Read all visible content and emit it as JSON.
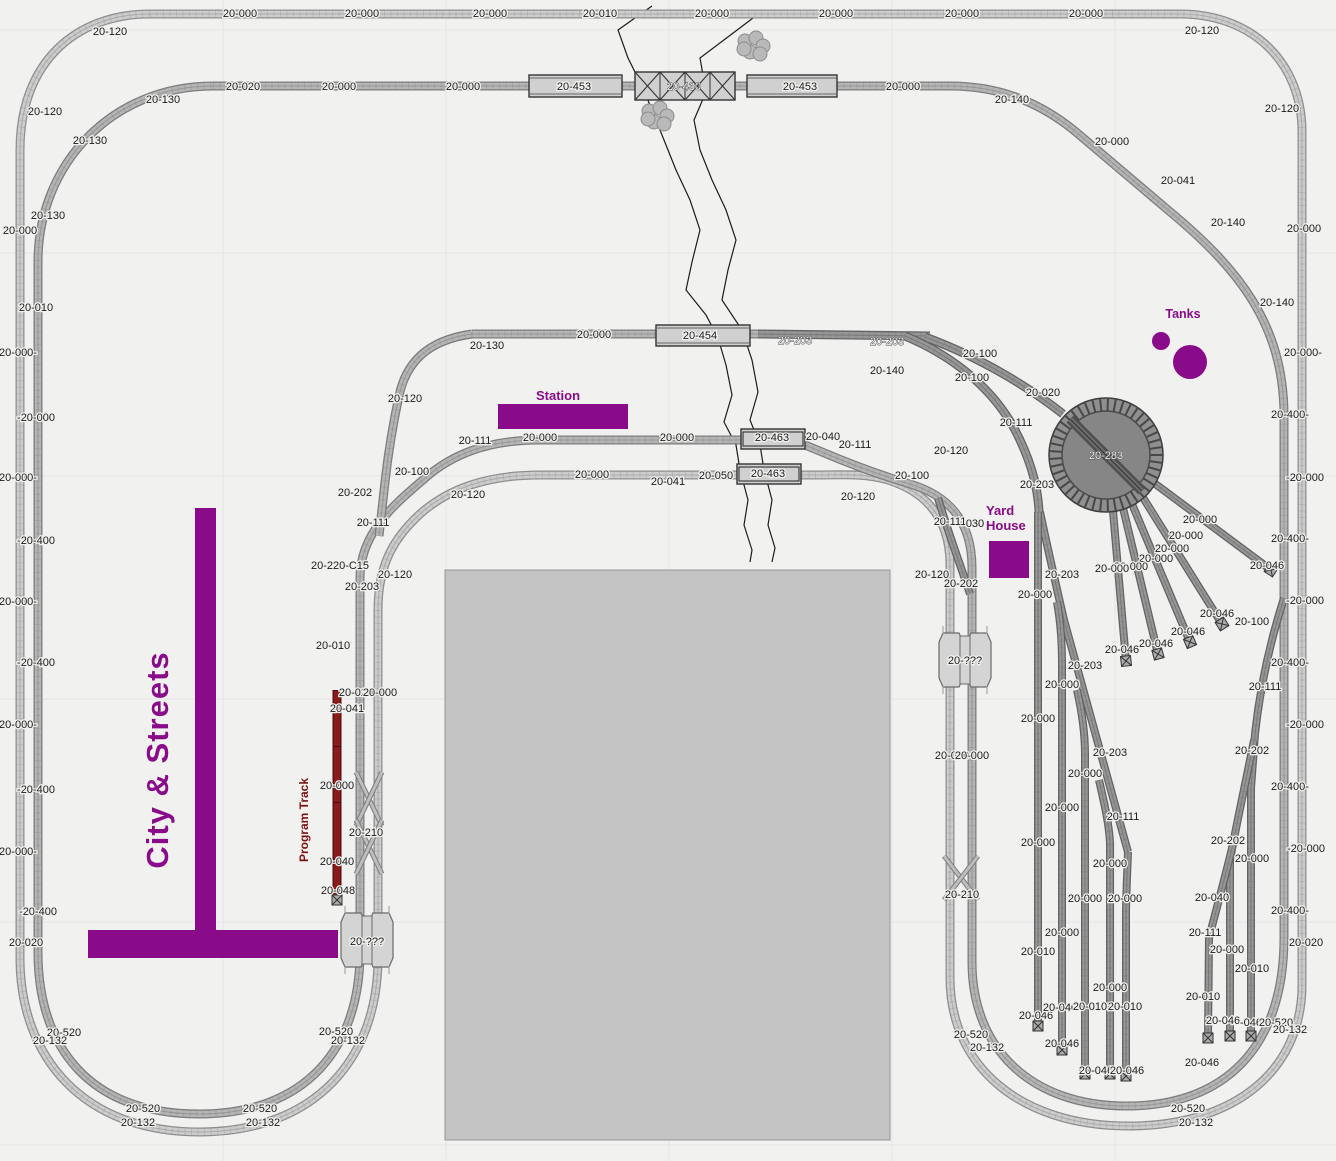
{
  "canvas": {
    "width": 1336,
    "height": 1161,
    "bg": "#f1f1ef"
  },
  "colors": {
    "accent": "#8a0b8a",
    "program_red": "#8b1a1a",
    "program_red_dark": "#541010",
    "program_text": "#7c1212",
    "label": "#1b1b1b",
    "halo": "#f1f1ef",
    "grid": "#e5e5e8",
    "river": "#1c1c1c",
    "building_fill": "#c3c3c3",
    "building_edge": "#979797",
    "light_fill": "#cdcdcd",
    "light_edge": "#8f8f8f",
    "med_fill": "#b5b5b5",
    "med_edge": "#7d7d7d",
    "dark_fill": "#979797",
    "dark_edge": "#636363",
    "bridge_fill": "#d0d0d0",
    "bridge_edge": "#333333",
    "crossing_fill": "#d4d4d4",
    "crossing_edge": "#6a6a6a",
    "tree_fill": "#b9b9b9",
    "tree_edge": "#8c8c8c",
    "turntable_fill": "#8f8f8f",
    "turntable_inner": "#868686",
    "turntable_edge": "#3d3d3d"
  },
  "annotations": {
    "city_streets": "City & Streets",
    "station": "Station",
    "tanks": "Tanks",
    "yard_house": "Yard House",
    "program_track": "Program Track"
  },
  "grid": {
    "xs": [
      223,
      446,
      669,
      892,
      1115
    ],
    "ys": [
      30,
      253,
      476,
      699,
      922,
      1145
    ]
  },
  "tracks": [
    {
      "tone": "light",
      "w": 9,
      "d": "M 150,14 L 1180,14 C 1252,14 1302,62 1302,132 L 1302,985 C 1302,1068 1238,1126 1128,1126 C 1020,1126 950,1066 950,978 L 950,565 C 950,518 926,492 888,480 C 864,473 840,475 818,475 L 540,475 C 486,475 448,489 420,514 C 396,536 378,562 378,610 L 378,958 C 378,1058 316,1132 199,1132 C 84,1132 20,1058 20,958 L 20,150 C 20,62 76,14 150,14 Z"
    },
    {
      "tone": "med",
      "w": 9,
      "d": "M 213,86 L 950,86 C 1002,86 1042,104 1076,132 L 1168,210 C 1238,268 1284,324 1284,416 L 1284,938 C 1284,1048 1224,1106 1127,1106 C 1030,1106 972,1048 972,962 L 972,568 C 972,522 950,496 910,484 C 876,474 848,463 822,452 L 800,443 C 790,441 780,440 770,440 L 540,440 C 488,440 452,454 424,479 C 400,500 360,530 360,578 L 360,952 C 360,1048 306,1114 199,1114 C 90,1114 38,1048 38,952 L 38,262 C 38,164 112,86 213,86 Z"
    },
    {
      "tone": "med",
      "w": 9,
      "d": "M 472,334 L 762,334"
    },
    {
      "tone": "med",
      "w": 9,
      "d": "M 472,334 C 428,340 406,362 399,396 C 393,424 388,455 385,482 C 383,500 381,518 379,536"
    },
    {
      "tone": "dark",
      "w": 9,
      "d": "M 758,334 L 930,336"
    },
    {
      "tone": "dark",
      "w": 9,
      "d": "M 925,337 C 982,358 1030,388 1063,414"
    },
    {
      "tone": "dark",
      "w": 9,
      "d": "M 905,336 C 958,358 994,392 1014,428 C 1030,458 1038,486 1039,512"
    },
    {
      "tone": "dark",
      "w": 8,
      "d": "M 938,498 C 948,532 960,564 970,594"
    },
    {
      "tone": "dark",
      "w": 8,
      "d": "M 1040,512 C 1048,550 1056,585 1064,620 L 1128,852"
    },
    {
      "tone": "dark",
      "w": 8,
      "d": "M 1038,512 L 1038,1026"
    },
    {
      "tone": "dark",
      "w": 8,
      "d": "M 1057,602 C 1061,624 1062,644 1062,664 L 1062,1050"
    },
    {
      "tone": "dark",
      "w": 8,
      "d": "M 1077,690 C 1082,712 1085,734 1085,754 L 1085,1074"
    },
    {
      "tone": "dark",
      "w": 8,
      "d": "M 1099,780 C 1104,802 1109,823 1110,843 L 1110,1074"
    },
    {
      "tone": "dark",
      "w": 8,
      "d": "M 1128,852 C 1127,878 1126,898 1126,916 L 1126,1076"
    },
    {
      "tone": "dark",
      "w": 8,
      "d": "M 1150,480 L 1271,570"
    },
    {
      "tone": "dark",
      "w": 8,
      "d": "M 1142,496 L 1222,624"
    },
    {
      "tone": "dark",
      "w": 8,
      "d": "M 1132,504 L 1190,642"
    },
    {
      "tone": "dark",
      "w": 8,
      "d": "M 1123,508 L 1158,654"
    },
    {
      "tone": "dark",
      "w": 8,
      "d": "M 1113,511 L 1126,661"
    },
    {
      "tone": "dark",
      "w": 8,
      "d": "M 1284,598 C 1270,642 1260,688 1255,734 L 1251,788 L 1251,1036"
    },
    {
      "tone": "dark",
      "w": 8,
      "d": "M 1254,740 C 1245,786 1236,826 1230,860 L 1230,1036"
    },
    {
      "tone": "dark",
      "w": 8,
      "d": "M 1233,844 C 1224,882 1215,914 1209,938 L 1208,1038"
    }
  ],
  "crossover_lines": [
    "M 356,772 L 382,826",
    "M 382,772 L 356,826",
    "M 356,820 L 382,874",
    "M 382,820 L 356,874",
    "M 944,856 L 978,900",
    "M 978,856 L 944,900"
  ],
  "program_track": {
    "d": "M 337,690 L 337,900"
  },
  "bumpers": [
    [
      1271,
      570,
      33
    ],
    [
      1222,
      624,
      58
    ],
    [
      1190,
      642,
      67
    ],
    [
      1158,
      654,
      75
    ],
    [
      1126,
      661,
      84
    ],
    [
      1038,
      1026,
      90
    ],
    [
      1062,
      1050,
      90
    ],
    [
      1085,
      1074,
      90
    ],
    [
      1110,
      1074,
      90
    ],
    [
      1126,
      1076,
      90
    ],
    [
      1251,
      1036,
      90
    ],
    [
      1230,
      1036,
      90
    ],
    [
      1208,
      1038,
      90
    ],
    [
      337,
      900,
      90
    ]
  ],
  "turntable": {
    "cx": 1106,
    "cy": 455,
    "r_outer": 57,
    "r_ring": 44,
    "label": "20-283"
  },
  "bridges": [
    {
      "type": "plate",
      "x": 529,
      "y": 75,
      "w": 93,
      "h": 22
    },
    {
      "type": "truss",
      "x": 635,
      "y": 72,
      "w": 100,
      "h": 28
    },
    {
      "type": "plate",
      "x": 747,
      "y": 75,
      "w": 90,
      "h": 22
    },
    {
      "type": "plate",
      "x": 656,
      "y": 325,
      "w": 94,
      "h": 21
    },
    {
      "type": "double",
      "x": 741,
      "y": 429,
      "w": 64,
      "h": 20
    },
    {
      "type": "double",
      "x": 737,
      "y": 464,
      "w": 64,
      "h": 20
    }
  ],
  "crossings": [
    {
      "cx": 367,
      "cy": 940
    },
    {
      "cx": 965,
      "cy": 660
    }
  ],
  "building": {
    "x": 445,
    "y": 570,
    "w": 445,
    "h": 570
  },
  "streets": [
    {
      "x": 195,
      "y": 508,
      "w": 21,
      "h": 424
    },
    {
      "x": 88,
      "y": 930,
      "w": 250,
      "h": 28
    }
  ],
  "station_rect": {
    "x": 498,
    "y": 404,
    "w": 130,
    "h": 25
  },
  "yard_house_rect": {
    "x": 989,
    "y": 541,
    "w": 40,
    "h": 37
  },
  "tanks": [
    {
      "cx": 1161,
      "cy": 341,
      "r": 9
    },
    {
      "cx": 1190,
      "cy": 362,
      "r": 17
    }
  ],
  "trees": [
    {
      "cx": 753,
      "cy": 47
    },
    {
      "cx": 657,
      "cy": 117
    }
  ],
  "river": [
    [
      [
        652,
        6
      ],
      [
        618,
        30
      ],
      [
        628,
        58
      ],
      [
        642,
        86
      ],
      [
        652,
        110
      ],
      [
        664,
        140
      ],
      [
        676,
        170
      ],
      [
        690,
        200
      ],
      [
        700,
        230
      ],
      [
        692,
        262
      ],
      [
        686,
        290
      ],
      [
        706,
        315
      ],
      [
        718,
        338
      ],
      [
        726,
        365
      ],
      [
        732,
        395
      ],
      [
        724,
        422
      ],
      [
        736,
        445
      ],
      [
        740,
        470
      ],
      [
        748,
        500
      ],
      [
        744,
        525
      ],
      [
        752,
        550
      ],
      [
        750,
        562
      ]
    ],
    [
      [
        757,
        15
      ],
      [
        700,
        58
      ],
      [
        706,
        92
      ],
      [
        694,
        120
      ],
      [
        700,
        150
      ],
      [
        712,
        180
      ],
      [
        726,
        210
      ],
      [
        736,
        240
      ],
      [
        728,
        270
      ],
      [
        722,
        300
      ],
      [
        742,
        330
      ],
      [
        752,
        360
      ],
      [
        758,
        392
      ],
      [
        750,
        420
      ],
      [
        760,
        445
      ],
      [
        764,
        470
      ],
      [
        772,
        500
      ],
      [
        768,
        525
      ],
      [
        775,
        548
      ],
      [
        772,
        562
      ]
    ]
  ],
  "labels": [
    [
      "20-000",
      240,
      13
    ],
    [
      "20-000",
      362,
      13
    ],
    [
      "20-000",
      490,
      13
    ],
    [
      "20-010",
      600,
      13
    ],
    [
      "20-000",
      712,
      13
    ],
    [
      "20-000",
      836,
      13
    ],
    [
      "20-000",
      962,
      13
    ],
    [
      "20-000",
      1086,
      13
    ],
    [
      "20-120",
      110,
      31
    ],
    [
      "20-120",
      1202,
      30
    ],
    [
      "20-130",
      163,
      99
    ],
    [
      "20-020",
      243,
      86
    ],
    [
      "20-000",
      339,
      86
    ],
    [
      "20-000",
      463,
      86
    ],
    [
      "20-453",
      574,
      86
    ],
    [
      "20-430",
      684,
      86,
      "o"
    ],
    [
      "20-453",
      800,
      86
    ],
    [
      "20-000",
      903,
      86
    ],
    [
      "20-140",
      1012,
      99
    ],
    [
      "20-000",
      1112,
      141
    ],
    [
      "20-041",
      1178,
      180
    ],
    [
      "20-140",
      1228,
      222
    ],
    [
      "20-120",
      1282,
      108
    ],
    [
      "20-000",
      1304,
      228
    ],
    [
      "20-140",
      1277,
      302
    ],
    [
      "20-000-",
      1303,
      352
    ],
    [
      "20-400-",
      1290,
      414
    ],
    [
      "-20-000",
      1305,
      477
    ],
    [
      "20-400-",
      1290,
      538
    ],
    [
      "-20-000",
      1305,
      600
    ],
    [
      "20-400-",
      1290,
      662
    ],
    [
      "-20-000",
      1305,
      724
    ],
    [
      "20-400-",
      1290,
      786
    ],
    [
      "-20-000",
      1306,
      848
    ],
    [
      "20-400-",
      1290,
      910
    ],
    [
      "20-020",
      1306,
      942
    ],
    [
      "20-120",
      45,
      111
    ],
    [
      "20-130",
      90,
      140
    ],
    [
      "20-130",
      48,
      215
    ],
    [
      "20-000",
      20,
      230
    ],
    [
      "20-010",
      36,
      307
    ],
    [
      "20-000-",
      18,
      352
    ],
    [
      "-20-000",
      36,
      417
    ],
    [
      "20-000-",
      18,
      477
    ],
    [
      "-20-400",
      36,
      540
    ],
    [
      "20-000-",
      18,
      601
    ],
    [
      "-20-400",
      36,
      662
    ],
    [
      "20-000-",
      18,
      724
    ],
    [
      "-20-400",
      36,
      789
    ],
    [
      "20-000-",
      18,
      851
    ],
    [
      "-20-400",
      38,
      911
    ],
    [
      "20-020",
      26,
      942
    ],
    [
      "20-520",
      64,
      1032
    ],
    [
      "20-132",
      50,
      1040
    ],
    [
      "20-520",
      143,
      1108
    ],
    [
      "20-132",
      138,
      1122
    ],
    [
      "20-520",
      260,
      1108
    ],
    [
      "20-132",
      263,
      1122
    ],
    [
      "20-520",
      336,
      1031
    ],
    [
      "20-132",
      348,
      1040
    ],
    [
      "20-130",
      487,
      345
    ],
    [
      "20-000",
      594,
      334
    ],
    [
      "20-454",
      700,
      335
    ],
    [
      "20-203",
      795,
      340,
      "o"
    ],
    [
      "20-203",
      887,
      341,
      "o"
    ],
    [
      "20-140",
      887,
      370
    ],
    [
      "20-100",
      980,
      353
    ],
    [
      "20-100",
      972,
      377
    ],
    [
      "20-020",
      1043,
      392
    ],
    [
      "20-111",
      1016,
      422
    ],
    [
      "20-120",
      405,
      398
    ],
    [
      "20-111",
      475,
      440
    ],
    [
      "20-000",
      540,
      437
    ],
    [
      "20-000",
      677,
      437
    ],
    [
      "20-463",
      772,
      437
    ],
    [
      "20-040",
      823,
      436
    ],
    [
      "20-111",
      855,
      444
    ],
    [
      "20-120",
      951,
      450
    ],
    [
      "20-100",
      412,
      471
    ],
    [
      "20-120",
      468,
      494
    ],
    [
      "20-000",
      592,
      474
    ],
    [
      "20-041",
      668,
      481
    ],
    [
      "20-050",
      716,
      475
    ],
    [
      "20-463",
      768,
      473
    ],
    [
      "20-120",
      858,
      496
    ],
    [
      "20-100",
      912,
      475
    ],
    [
      "20-202",
      355,
      492
    ],
    [
      "20-111",
      373,
      522
    ],
    [
      "20-220-C15",
      340,
      565
    ],
    [
      "20-203",
      362,
      586
    ],
    [
      "20-120",
      395,
      574
    ],
    [
      "20-010",
      333,
      645
    ],
    [
      "20-020",
      356,
      692
    ],
    [
      "20-000",
      380,
      692
    ],
    [
      "20-041",
      347,
      708
    ],
    [
      "20-000",
      337,
      785
    ],
    [
      "20-210",
      366,
      832
    ],
    [
      "20-040",
      337,
      861
    ],
    [
      "20-048",
      338,
      890
    ],
    [
      "20-111",
      950,
      521
    ],
    [
      "030",
      975,
      523
    ],
    [
      "20-120",
      932,
      574
    ],
    [
      "20-202",
      961,
      583
    ],
    [
      "20-???",
      367,
      941
    ],
    [
      "20-???",
      965,
      660
    ],
    [
      "20-000",
      952,
      755
    ],
    [
      "20-000",
      972,
      755
    ],
    [
      "20-210",
      962,
      894
    ],
    [
      "20-520",
      971,
      1034
    ],
    [
      "20-132",
      987,
      1047
    ],
    [
      "20-000",
      1200,
      519
    ],
    [
      "20-000",
      1186,
      535
    ],
    [
      "20-000",
      1172,
      548
    ],
    [
      "20-000",
      1156,
      558
    ],
    [
      "20-000",
      1131,
      566
    ],
    [
      "20-000",
      1112,
      568
    ],
    [
      "20-046",
      1267,
      565
    ],
    [
      "20-046",
      1217,
      613
    ],
    [
      "20-100",
      1252,
      621
    ],
    [
      "20-046",
      1188,
      631
    ],
    [
      "20-046",
      1156,
      643
    ],
    [
      "20-046",
      1122,
      649
    ],
    [
      "20-203",
      1037,
      484
    ],
    [
      "20-203",
      1062,
      574
    ],
    [
      "20-203",
      1085,
      665
    ],
    [
      "20-203",
      1110,
      752
    ],
    [
      "20-111",
      1123,
      816
    ],
    [
      "20-000",
      1035,
      594
    ],
    [
      "20-000",
      1038,
      718
    ],
    [
      "20-000",
      1038,
      842
    ],
    [
      "20-010",
      1038,
      951
    ],
    [
      "20-046",
      1036,
      1015
    ],
    [
      "20-000",
      1062,
      684
    ],
    [
      "20-000",
      1062,
      807
    ],
    [
      "20-000",
      1062,
      932
    ],
    [
      "20-046",
      1062,
      1043
    ],
    [
      "20-000",
      1085,
      773
    ],
    [
      "20-000",
      1085,
      898
    ],
    [
      "20-040",
      1060,
      1007
    ],
    [
      "20-010",
      1090,
      1006
    ],
    [
      "20-000",
      1110,
      863
    ],
    [
      "20-000",
      1110,
      987
    ],
    [
      "20-000",
      1125,
      898
    ],
    [
      "20-010",
      1125,
      1006
    ],
    [
      "20-046",
      1096,
      1070
    ],
    [
      "20-046",
      1127,
      1070
    ],
    [
      "20-111",
      1265,
      686
    ],
    [
      "20-202",
      1252,
      750
    ],
    [
      "20-202",
      1228,
      840
    ],
    [
      "20-000",
      1252,
      858
    ],
    [
      "20-040",
      1212,
      897
    ],
    [
      "20-111",
      1205,
      932
    ],
    [
      "20-000",
      1227,
      949
    ],
    [
      "20-010",
      1252,
      968
    ],
    [
      "20-010",
      1203,
      996
    ],
    [
      "20-046",
      1223,
      1020
    ],
    [
      "-046",
      1251,
      1022
    ],
    [
      "20-520",
      1276,
      1022
    ],
    [
      "20-132",
      1290,
      1029
    ],
    [
      "20-046",
      1202,
      1062
    ],
    [
      "20-520",
      1188,
      1108
    ],
    [
      "20-132",
      1196,
      1122
    ]
  ]
}
